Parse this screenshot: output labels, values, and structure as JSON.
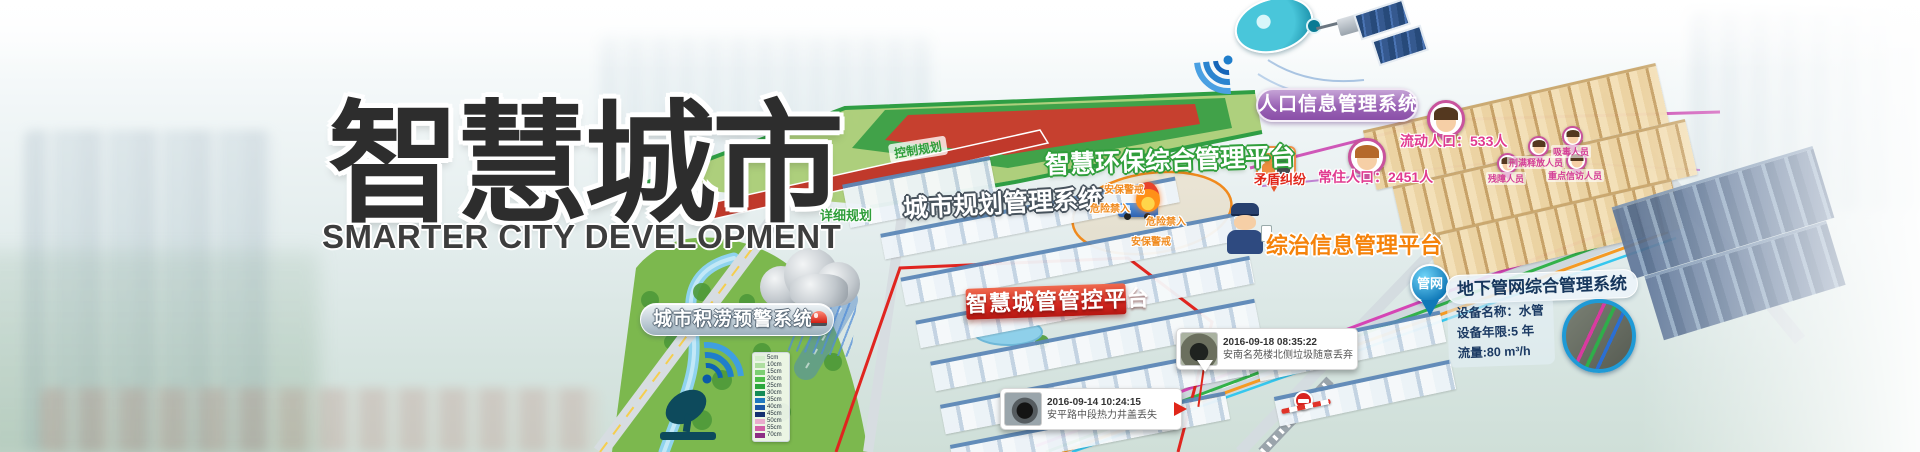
{
  "hero": {
    "title": "智慧城市",
    "subtitle": "SMARTER CITY DEVELOPMENT"
  },
  "labels": {
    "city_planning": "城市规划管理系统",
    "environment": "智慧环保综合管理平台",
    "population_system": "人口信息管理系统",
    "comprehensive_governance": "综治信息管理平台",
    "city_management": "智慧城管管控平台",
    "underground_pipeline": "地下管网综合管理系统",
    "waterlog_warning": "城市积涝预警系统",
    "control_plan": "控制规划",
    "detail_plan": "详细规划"
  },
  "population": {
    "resident": "常住人口：2451人",
    "floating": "流动人口：533人",
    "conflict": "矛盾纠纷",
    "focus_groups": [
      "吸毒人员",
      "刑满释放人员",
      "残障人员",
      "重点信访人员"
    ]
  },
  "security": {
    "patrol": "安保警戒",
    "danger": "危险禁入"
  },
  "pipeline": {
    "pin": "管网",
    "device_name": "设备名称：水管",
    "device_age": "设备年限:5 年",
    "flow": "流量:80 m³/h"
  },
  "events": [
    {
      "time": "2016-09-18 08:35:22",
      "desc": "安南名苑楼北侧垃圾随意丢弃"
    },
    {
      "time": "2016-09-14 10:24:15",
      "desc": "安平路中段热力井盖丢失"
    }
  ],
  "flood_legend": [
    {
      "label": "5cm",
      "color": "#d4eecd"
    },
    {
      "label": "10cm",
      "color": "#aede9f"
    },
    {
      "label": "15cm",
      "color": "#7ccf72"
    },
    {
      "label": "20cm",
      "color": "#4dbe4b"
    },
    {
      "label": "25cm",
      "color": "#2aa63c"
    },
    {
      "label": "30cm",
      "color": "#148b57"
    },
    {
      "label": "35cm",
      "color": "#1e78c0"
    },
    {
      "label": "40cm",
      "color": "#1a56a6"
    },
    {
      "label": "45cm",
      "color": "#143070"
    },
    {
      "label": "50cm",
      "color": "#eaaccd"
    },
    {
      "label": "55cm",
      "color": "#d160a6"
    },
    {
      "label": "70cm",
      "color": "#8c2d84"
    }
  ],
  "colors": {
    "banner_red": "#d42720",
    "population_purple": "#9a63b5",
    "env_green": "#2f9e3a",
    "governance_orange": "#f5820a",
    "pin_blue": "#1e88c9",
    "alert_magenta": "#e13a90"
  }
}
